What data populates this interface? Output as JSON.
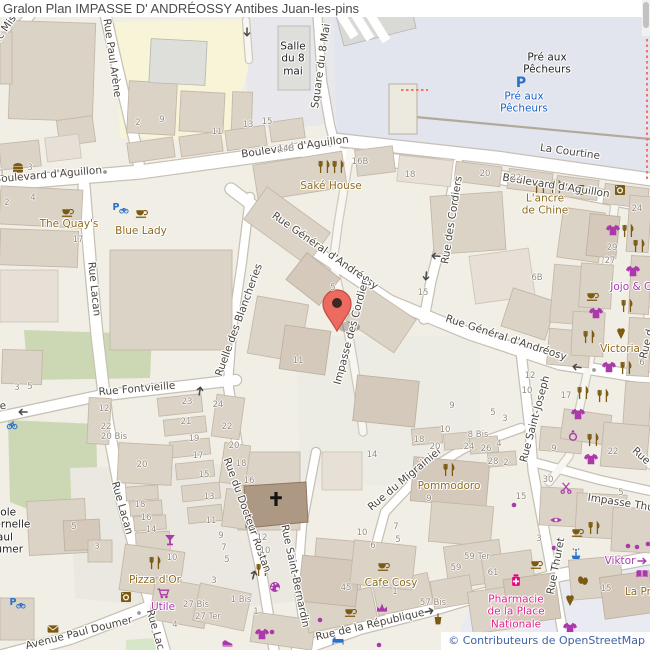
{
  "title": {
    "text": "Gralon Plan IMPASSE D' ANDRÉOSSY Antibes Juan-les-pins"
  },
  "attribution": {
    "text": "© Contributeurs de OpenStreetMap"
  },
  "colors": {
    "street_label": "#49453e",
    "brown": "#8d6b1f",
    "magenta": "#ac39ac",
    "blue": "#1a5fc4",
    "black": "#1f1f1f",
    "pink": "#e0218a",
    "number_gray": "#938b80",
    "marker_red": "#ec6a5e",
    "land": "#f1eee6",
    "esplanade": "#e2e4ee",
    "building": "#dcd3c7",
    "park": "#ccd8b4"
  },
  "map": {
    "marker": {
      "x": 337,
      "y": 304
    },
    "street_labels": [
      {
        "text": "Boulevard d'Aguillon",
        "x": 48,
        "y": 175,
        "rot": -5
      },
      {
        "text": "Boulevard d'Aguillon",
        "x": 295,
        "y": 147,
        "rot": -8
      },
      {
        "text": "Boulevard d'Aguillon",
        "x": 556,
        "y": 186,
        "rot": 9
      },
      {
        "text": "La Courtine",
        "x": 570,
        "y": 152,
        "rot": 8
      },
      {
        "text": "Square du 8 Mai",
        "x": 321,
        "y": 66,
        "rot": -82
      },
      {
        "text": "Rue Paul Arène",
        "x": 112,
        "y": 58,
        "rot": 82
      },
      {
        "text": "Frédéric Mis",
        "x": -4,
        "y": 42,
        "rot": -55
      },
      {
        "text": "Rue Général d'Andréosy",
        "x": 325,
        "y": 251,
        "rot": 35
      },
      {
        "text": "Rue Général d'Andréosy",
        "x": 506,
        "y": 338,
        "rot": 18
      },
      {
        "text": "Rue des Cordiers",
        "x": 452,
        "y": 220,
        "rot": -81
      },
      {
        "text": "Impasse des Cordiers",
        "x": 352,
        "y": 330,
        "rot": -75
      },
      {
        "text": "Rue Lacan",
        "x": 94,
        "y": 289,
        "rot": 84
      },
      {
        "text": "Rue Lacan",
        "x": 122,
        "y": 508,
        "rot": 74
      },
      {
        "text": "Rue Lacan",
        "x": 157,
        "y": 636,
        "rot": 74
      },
      {
        "text": "Rue Fontvieille",
        "x": 137,
        "y": 389,
        "rot": -5
      },
      {
        "text": "Rue Fontvieille",
        "x": -32,
        "y": 411,
        "rot": -8
      },
      {
        "text": "Ruelle des Blancheries",
        "x": 239,
        "y": 320,
        "rot": -70
      },
      {
        "text": "Rue du Docteur Rostan",
        "x": 247,
        "y": 515,
        "rot": 70
      },
      {
        "text": "Rue Saint-Bernardin",
        "x": 295,
        "y": 576,
        "rot": 78
      },
      {
        "text": "Rue du Migrainier",
        "x": 405,
        "y": 479,
        "rot": -40
      },
      {
        "text": "Rue Saint-Joseph",
        "x": 535,
        "y": 419,
        "rot": -75
      },
      {
        "text": "Rue Thuret",
        "x": 556,
        "y": 566,
        "rot": -79
      },
      {
        "text": "Impasse Thuret",
        "x": 628,
        "y": 504,
        "rot": 9
      },
      {
        "text": "Rue de la République",
        "x": 370,
        "y": 625,
        "rot": -13
      },
      {
        "text": "Avenue Paul Doumer",
        "x": 79,
        "y": 633,
        "rot": -14
      },
      {
        "text": "Rue",
        "x": 641,
        "y": 456,
        "rot": 42
      },
      {
        "text": "Rue d",
        "x": 647,
        "y": 344,
        "rot": -76
      }
    ],
    "poi_labels": [
      {
        "text": "Saké House",
        "x": 331,
        "y": 186,
        "color": "brown"
      },
      {
        "text": "The Quay's",
        "x": 69,
        "y": 224,
        "color": "brown"
      },
      {
        "text": "Blue Lady",
        "x": 141,
        "y": 231,
        "color": "brown"
      },
      {
        "text": "L'ancre\nde Chine",
        "x": 545,
        "y": 205,
        "color": "brown"
      },
      {
        "text": "Jojo & Co",
        "x": 634,
        "y": 287,
        "color": "magenta"
      },
      {
        "text": "Victoria",
        "x": 620,
        "y": 349,
        "color": "brown"
      },
      {
        "text": "Pommodoro",
        "x": 449,
        "y": 486,
        "color": "brown"
      },
      {
        "text": "Cafe Cosy",
        "x": 391,
        "y": 583,
        "color": "brown"
      },
      {
        "text": "Pizza d'Or",
        "x": 155,
        "y": 580,
        "color": "brown"
      },
      {
        "text": "Utile",
        "x": 163,
        "y": 607,
        "color": "magenta"
      },
      {
        "text": "Viktor",
        "x": 620,
        "y": 561,
        "color": "magenta"
      },
      {
        "text": "La Pro",
        "x": 641,
        "y": 592,
        "color": "brown"
      },
      {
        "text": "Pharmacie\nde la Place\nNationale",
        "x": 516,
        "y": 612,
        "color": "pink"
      },
      {
        "text": "Pré aux\nPêcheurs",
        "x": 547,
        "y": 64,
        "color": "black"
      },
      {
        "text": "Pré aux\nPêcheurs",
        "x": 524,
        "y": 103,
        "color": "blue"
      },
      {
        "text": "Salle\ndu 8\nmai",
        "x": 293,
        "y": 59,
        "color": "black"
      },
      {
        "text": "École\nmaternelle\nPaul\nDoumer",
        "x": 2,
        "y": 531,
        "color": "black"
      }
    ],
    "house_numbers": [
      [
        "1",
        2,
        174
      ],
      [
        "3",
        30,
        168
      ],
      [
        "2",
        7,
        203
      ],
      [
        "4",
        33,
        198
      ],
      [
        "2",
        138,
        123
      ],
      [
        "9",
        162,
        120
      ],
      [
        "11",
        217,
        132
      ],
      [
        "13",
        248,
        125
      ],
      [
        "15",
        267,
        122
      ],
      [
        "14B",
        286,
        149
      ],
      [
        "16B",
        360,
        162
      ],
      [
        "18",
        410,
        175
      ],
      [
        "20",
        485,
        174
      ],
      [
        "22",
        516,
        178
      ],
      [
        "24",
        637,
        209
      ],
      [
        "29",
        612,
        248
      ],
      [
        "27",
        610,
        261
      ],
      [
        "17",
        78,
        240
      ],
      [
        "15",
        423,
        293
      ],
      [
        "5",
        333,
        288
      ],
      [
        "11",
        298,
        361
      ],
      [
        "6B",
        537,
        278
      ],
      [
        "12",
        530,
        376
      ],
      [
        "10",
        527,
        391
      ],
      [
        "17",
        566,
        396
      ],
      [
        "5",
        493,
        413
      ],
      [
        "3",
        505,
        419
      ],
      [
        "9",
        452,
        406
      ],
      [
        "6",
        642,
        363
      ],
      [
        "3",
        17,
        388
      ],
      [
        "5",
        30,
        387
      ],
      [
        "12",
        104,
        409
      ],
      [
        "22",
        106,
        427
      ],
      [
        "20 Bis",
        114,
        437
      ],
      [
        "23",
        187,
        402
      ],
      [
        "21",
        186,
        422
      ],
      [
        "19",
        194,
        439
      ],
      [
        "17",
        198,
        456
      ],
      [
        "15",
        204,
        475
      ],
      [
        "13",
        209,
        497
      ],
      [
        "11",
        211,
        521
      ],
      [
        "9",
        221,
        536
      ],
      [
        "7",
        224,
        548
      ],
      [
        "5",
        227,
        560
      ],
      [
        "3",
        214,
        581
      ],
      [
        "24",
        218,
        405
      ],
      [
        "22",
        227,
        427
      ],
      [
        "20",
        234,
        446
      ],
      [
        "18",
        241,
        464
      ],
      [
        "16",
        249,
        481
      ],
      [
        "20",
        142,
        465
      ],
      [
        "18",
        140,
        505
      ],
      [
        "16",
        146,
        518
      ],
      [
        "14",
        151,
        530
      ],
      [
        "10",
        172,
        558
      ],
      [
        "5",
        74,
        527
      ],
      [
        "3",
        97,
        547
      ],
      [
        "27 Bis",
        196,
        605
      ],
      [
        "27 Ter",
        208,
        617
      ],
      [
        "1 Bis",
        241,
        600
      ],
      [
        "1",
        256,
        612
      ],
      [
        "12",
        262,
        538
      ],
      [
        "10",
        265,
        551
      ],
      [
        "4",
        175,
        625
      ],
      [
        "14",
        372,
        455
      ],
      [
        "10",
        362,
        533
      ],
      [
        "6",
        373,
        546
      ],
      [
        "7",
        396,
        527
      ],
      [
        "5",
        398,
        540
      ],
      [
        "45",
        346,
        588
      ],
      [
        "1",
        395,
        592
      ],
      [
        "18",
        419,
        440
      ],
      [
        "20",
        435,
        447
      ],
      [
        "8 Bis",
        478,
        435
      ],
      [
        "24",
        469,
        447
      ],
      [
        "26",
        486,
        449
      ],
      [
        "4",
        499,
        444
      ],
      [
        "28",
        493,
        462
      ],
      [
        "2",
        506,
        463
      ],
      [
        "9",
        429,
        499
      ],
      [
        "10",
        445,
        430
      ],
      [
        "30",
        548,
        480
      ],
      [
        "15",
        521,
        497
      ],
      [
        "3",
        539,
        539
      ],
      [
        "9",
        554,
        449
      ],
      [
        "22",
        613,
        452
      ],
      [
        "5",
        621,
        493
      ],
      [
        "59 Ter",
        477,
        557
      ],
      [
        "59",
        456,
        568
      ],
      [
        "61",
        493,
        573
      ],
      [
        "57 Bis",
        433,
        603
      ],
      [
        "15",
        606,
        589
      ]
    ],
    "icons": [
      {
        "t": "rest",
        "x": 324,
        "y": 167
      },
      {
        "t": "rest",
        "x": 338,
        "y": 167
      },
      {
        "t": "rest",
        "x": 540,
        "y": 187
      },
      {
        "t": "rest",
        "x": 556,
        "y": 187
      },
      {
        "t": "rest",
        "x": 449,
        "y": 470
      },
      {
        "t": "rest",
        "x": 262,
        "y": 570
      },
      {
        "t": "rest",
        "x": 155,
        "y": 563
      },
      {
        "t": "rest",
        "x": 594,
        "y": 528
      },
      {
        "t": "rest",
        "x": 628,
        "y": 231
      },
      {
        "t": "rest",
        "x": 639,
        "y": 246
      },
      {
        "t": "rest",
        "x": 627,
        "y": 306
      },
      {
        "t": "rest",
        "x": 589,
        "y": 337
      },
      {
        "t": "rest",
        "x": 626,
        "y": 368
      },
      {
        "t": "rest",
        "x": 583,
        "y": 393
      },
      {
        "t": "rest",
        "x": 603,
        "y": 396
      },
      {
        "t": "rest",
        "x": 593,
        "y": 440
      },
      {
        "t": "cup",
        "x": 67,
        "y": 212
      },
      {
        "t": "cup",
        "x": 141,
        "y": 213
      },
      {
        "t": "cup",
        "x": 383,
        "y": 566
      },
      {
        "t": "cup",
        "x": 536,
        "y": 564
      },
      {
        "t": "cup",
        "x": 350,
        "y": 612
      },
      {
        "t": "cup",
        "x": 592,
        "y": 296
      },
      {
        "t": "cup",
        "x": 577,
        "y": 532
      },
      {
        "t": "beer",
        "x": 581,
        "y": 190
      },
      {
        "t": "burger",
        "x": 18,
        "y": 168
      },
      {
        "t": "laundry",
        "x": 620,
        "y": 190
      },
      {
        "t": "laundry",
        "x": 126,
        "y": 597
      },
      {
        "t": "tshirt",
        "x": 613,
        "y": 230
      },
      {
        "t": "tshirt",
        "x": 633,
        "y": 271
      },
      {
        "t": "tshirt",
        "x": 596,
        "y": 313
      },
      {
        "t": "tshirt",
        "x": 609,
        "y": 367
      },
      {
        "t": "tshirt",
        "x": 578,
        "y": 414
      },
      {
        "t": "tshirt",
        "x": 591,
        "y": 459
      },
      {
        "t": "tshirt",
        "x": 570,
        "y": 628
      },
      {
        "t": "tshirt",
        "x": 262,
        "y": 634
      },
      {
        "t": "icecream",
        "x": 621,
        "y": 333
      },
      {
        "t": "icecream",
        "x": 570,
        "y": 600
      },
      {
        "t": "cocktail",
        "x": 170,
        "y": 540
      },
      {
        "t": "cart",
        "x": 163,
        "y": 593
      },
      {
        "t": "scissors",
        "x": 566,
        "y": 488
      },
      {
        "t": "eye",
        "x": 556,
        "y": 520
      },
      {
        "t": "ring",
        "x": 573,
        "y": 435
      },
      {
        "t": "palette",
        "x": 275,
        "y": 587
      },
      {
        "t": "shoes",
        "x": 228,
        "y": 642
      },
      {
        "t": "crown",
        "x": 382,
        "y": 608
      },
      {
        "t": "book",
        "x": 642,
        "y": 574
      },
      {
        "t": "masks",
        "x": 583,
        "y": 580
      },
      {
        "t": "mail",
        "x": 53,
        "y": 629
      },
      {
        "t": "kebab",
        "x": 438,
        "y": 619
      },
      {
        "t": "pharmacy",
        "x": 516,
        "y": 580
      },
      {
        "t": "parking",
        "x": 521,
        "y": 82
      },
      {
        "t": "pbike",
        "x": 120,
        "y": 208
      },
      {
        "t": "pbike",
        "x": 17,
        "y": 603
      },
      {
        "t": "bike",
        "x": 12,
        "y": 425
      },
      {
        "t": "fountain",
        "x": 576,
        "y": 554
      },
      {
        "t": "bed",
        "x": 338,
        "y": 641
      },
      {
        "t": "dot",
        "x": 628,
        "y": 546
      },
      {
        "t": "dot",
        "x": 637,
        "y": 547
      },
      {
        "t": "dot",
        "x": 648,
        "y": 544
      },
      {
        "t": "dot",
        "x": 514,
        "y": 505
      },
      {
        "t": "dot",
        "x": 554,
        "y": 548
      },
      {
        "t": "dot",
        "x": 320,
        "y": 620
      },
      {
        "t": "dot",
        "x": 379,
        "y": 645
      },
      {
        "t": "dot",
        "x": 272,
        "y": 632
      },
      {
        "t": "gdot",
        "x": 105,
        "y": 172
      },
      {
        "t": "gdot",
        "x": 139,
        "y": 613
      },
      {
        "t": "gdot",
        "x": 151,
        "y": 615
      },
      {
        "t": "gdot",
        "x": 594,
        "y": 370
      },
      {
        "t": "arrow",
        "x": 65,
        "y": 172,
        "r": 180
      },
      {
        "t": "arrow",
        "x": 247,
        "y": 33,
        "r": 90
      },
      {
        "t": "arrow",
        "x": 435,
        "y": 256,
        "r": 183
      },
      {
        "t": "arrow",
        "x": 576,
        "y": 367,
        "r": 187
      },
      {
        "t": "arrow",
        "x": 426,
        "y": 277,
        "r": 95
      },
      {
        "t": "arrow",
        "x": 200,
        "y": 390,
        "r": -80
      },
      {
        "t": "arrow",
        "x": 254,
        "y": 574,
        "r": -75
      },
      {
        "t": "arrow",
        "x": 22,
        "y": 412,
        "r": 180
      },
      {
        "t": "arrow",
        "x": 430,
        "y": 611,
        "r": -13
      },
      {
        "t": "arrow",
        "x": 643,
        "y": 561,
        "r": 0,
        "c": "#ac39ac"
      }
    ]
  }
}
